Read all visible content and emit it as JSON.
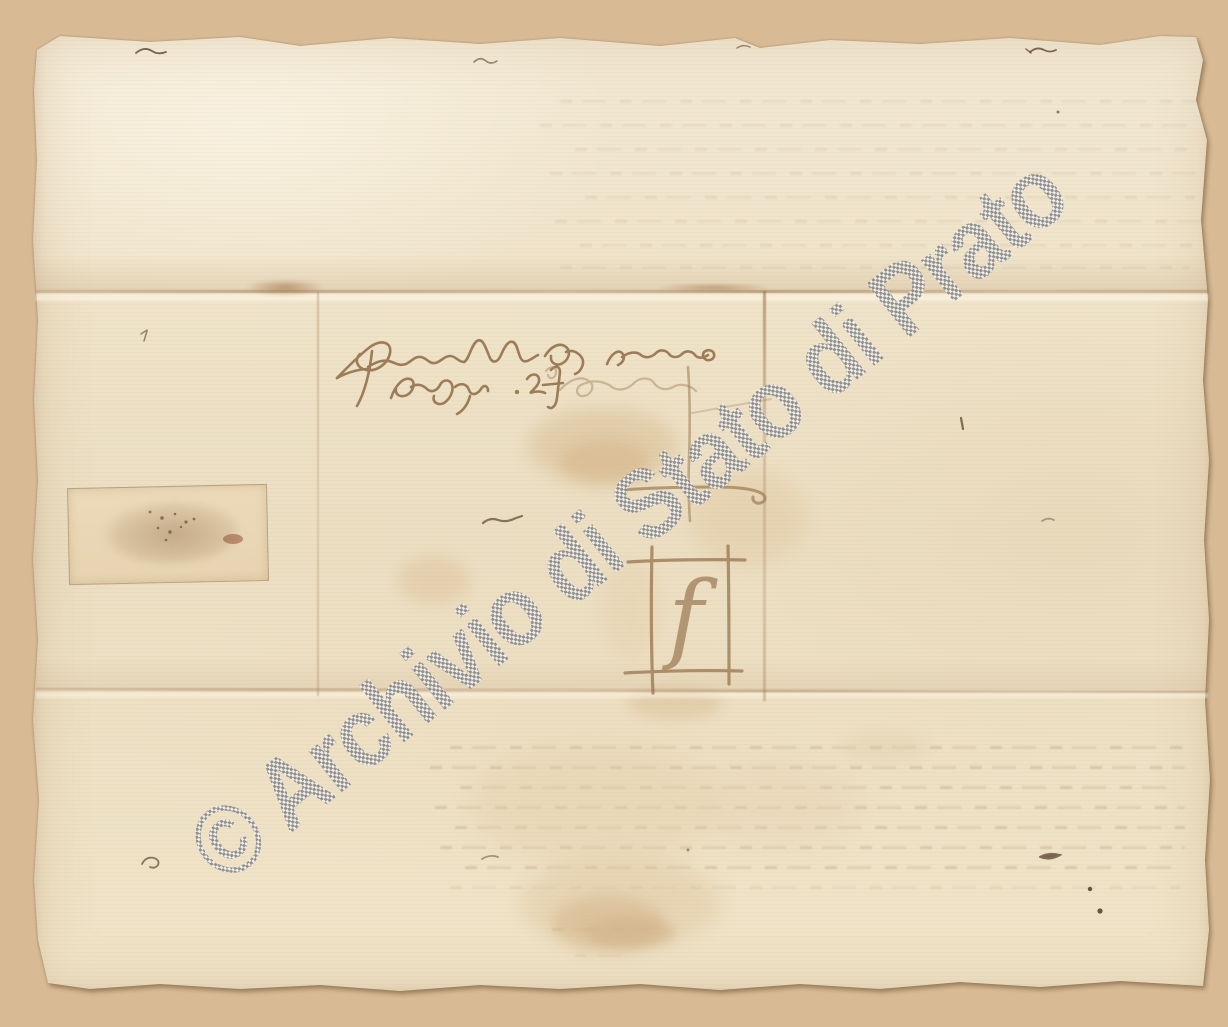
{
  "document": {
    "kind": "scanned archival letter, verso with address panel",
    "watermark": {
      "text": "© Archivio di Stato di Prato",
      "pattern": "gray checkerboard",
      "color": "#8b8b8b"
    },
    "inscription": {
      "address_line1_approx": "Francescho dapagholo za anno",
      "address_line2_approx": "degliabigh · 2f",
      "ink_color": "#8f6c45"
    },
    "marks": {
      "merchant_mark_letter": "f",
      "merchant_mark_desc": "square merchant mark frame containing letter f",
      "cross_mark_desc": "long vertical stroke crossed by hooked horizontal stroke above merchant mark"
    },
    "seal": {
      "desc": "rectangular paper patch over wax-seal remnant",
      "spot_color": "#8d4a2e"
    },
    "colors": {
      "background": "#d8bb95",
      "paper": "#efe3c9",
      "crease": "#a5825c",
      "stain": "#d8bb90"
    }
  }
}
